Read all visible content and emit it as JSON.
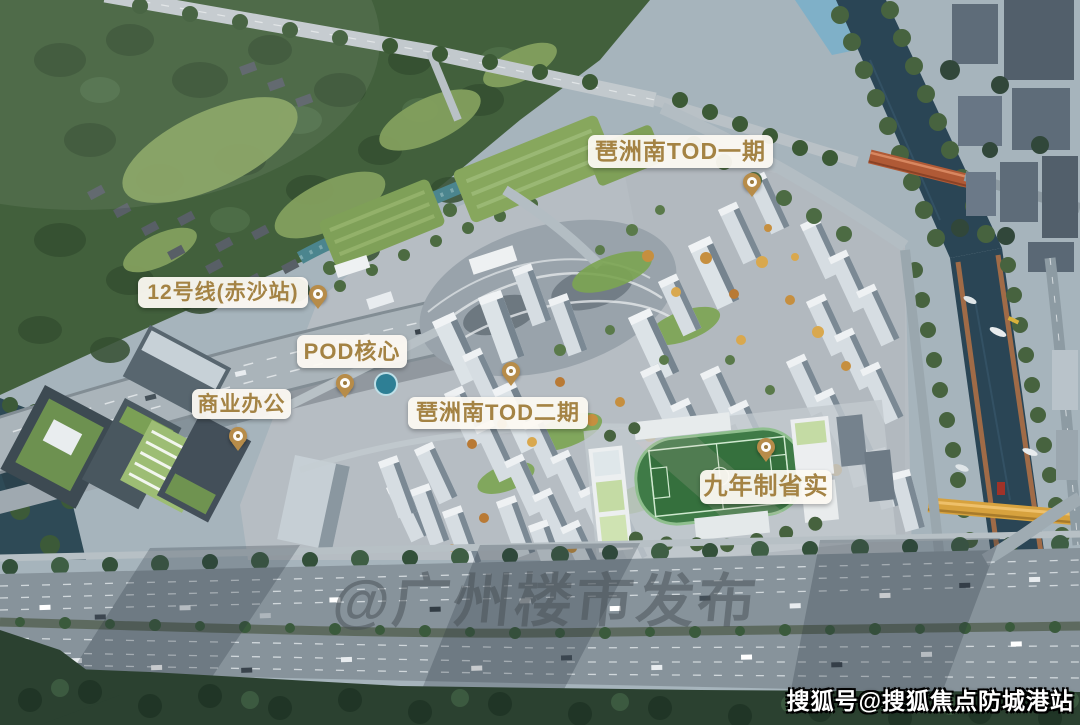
{
  "labels": [
    {
      "id": "tod-phase1",
      "text": "琶洲南TOD一期"
    },
    {
      "id": "line12-chisha-station",
      "text": "12号线(赤沙站)"
    },
    {
      "id": "pod-core",
      "text": "POD核心"
    },
    {
      "id": "commercial-office",
      "text": "商业办公"
    },
    {
      "id": "tod-phase2",
      "text": "琶洲南TOD二期"
    },
    {
      "id": "nine-year-school",
      "text": "九年制省实"
    }
  ],
  "watermark": {
    "text": "@广州楼市发布"
  },
  "attribution": {
    "text": "搜狐号@搜狐焦点防城港站"
  },
  "colors": {
    "label_text": "#a48344",
    "label_bg": "#fcf9f2",
    "pin_gold": "#b78c49",
    "river_water": "#2a4555",
    "bridge_red": "#b05a36",
    "bridge_yellow": "#d7a23e",
    "forest_green": "#42603c",
    "highway_gray": "#87939b"
  }
}
